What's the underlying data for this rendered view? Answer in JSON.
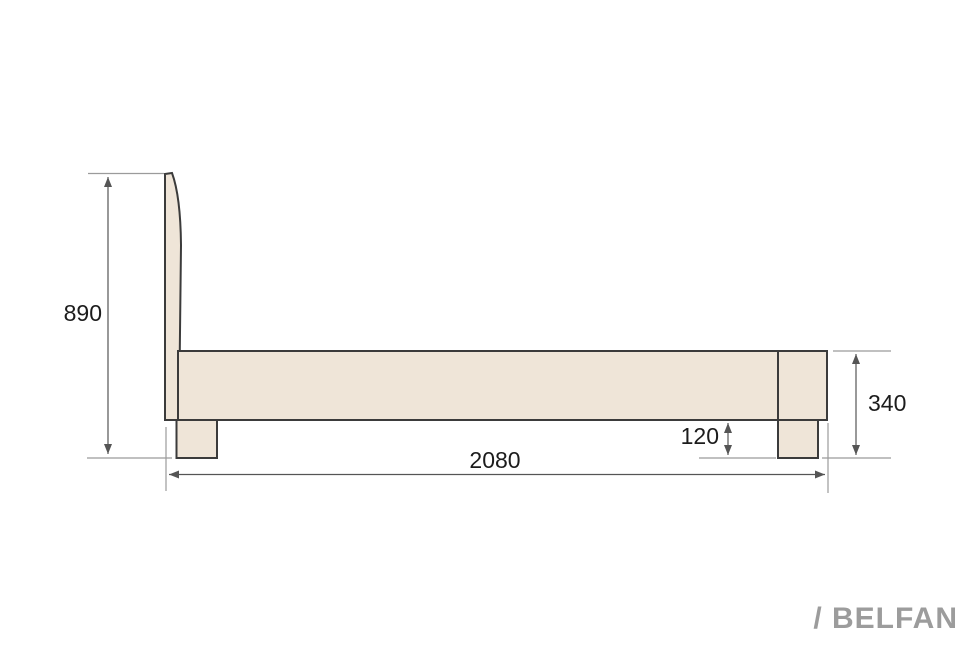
{
  "drawing": {
    "type": "furniture-technical-drawing",
    "view": "bed-side-view",
    "dimension_labels": {
      "headboard_height": "890",
      "overall_length": "2080",
      "footboard_height": "340",
      "leg_height": "120"
    }
  },
  "branding": {
    "logo_text": "/ BELFAN"
  },
  "colors": {
    "background": "#FFFFFF",
    "part_fill": "#EFE5D8",
    "part_outline": "#3B3B3B",
    "dimension_line": "#555555",
    "extension_line": "#9B9B9B",
    "label_text": "#1C1C1C",
    "logo_text": "#9C9C9C"
  }
}
